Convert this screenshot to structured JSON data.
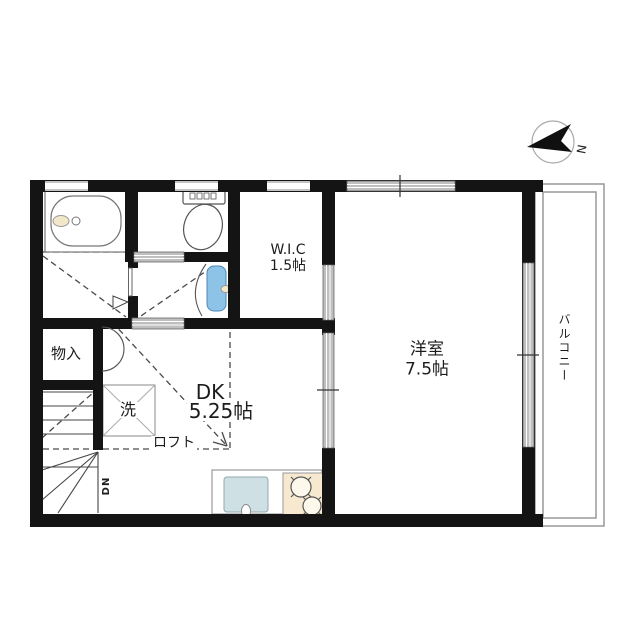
{
  "rooms": {
    "wic": {
      "name": "W.I.C",
      "size": "1.5帖"
    },
    "western": {
      "name": "洋室",
      "size": "7.5帖"
    },
    "dk": {
      "name": "DK",
      "size": "5.25帖"
    },
    "storage": {
      "name": "物入"
    },
    "washer": {
      "name": "洗"
    },
    "loft": {
      "name": "ロフト"
    },
    "balcony": {
      "name": "バルコニー"
    }
  },
  "stairs": {
    "direction_label": "DN"
  },
  "compass": {
    "north_label": "N"
  },
  "icons": {
    "bathtub": "bathtub-icon",
    "toilet": "toilet-icon",
    "washbasin": "washbasin-icon",
    "kitchen_sink": "kitchen-sink-icon",
    "stove": "stove-burner-icon",
    "washing_machine_pan": "washing-machine-pan-icon",
    "stairs_down": "stairs-down-icon",
    "compass_north": "compass-north-icon",
    "sliding_window": "sliding-window-icon",
    "door_swing": "door-swing-icon"
  },
  "colors": {
    "wall": "#141414",
    "thin_line": "#555555",
    "window_hatch": "#bfbfbf",
    "water_blue": "#8dc3e7",
    "sink_blue": "#cfe0e5",
    "stove_cream": "#f6e9cf",
    "fixture_cream": "#f2e7c9",
    "balcony_line": "#999999"
  }
}
